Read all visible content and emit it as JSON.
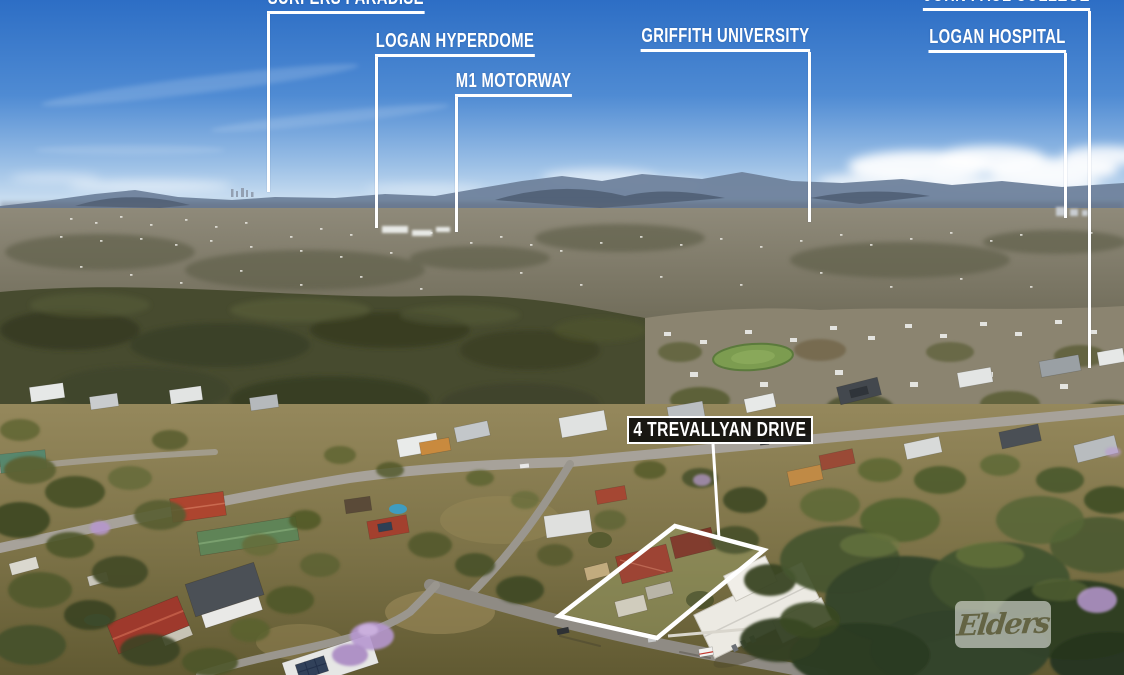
{
  "scene": {
    "type": "aerial-property-photo",
    "colors": {
      "callout_line": "#ffffff",
      "callout_text": "#ffffff",
      "property_box_bg": "#0a0a0a",
      "property_box_border": "#ffffff",
      "boundary_outline": "#ffffff",
      "sky_top": "#2d6ec5",
      "watermark_bg": "rgba(248,248,244,0.55)"
    }
  },
  "location_labels": [
    {
      "id": "surfers-paradise",
      "label": "SURFERS PARADISE"
    },
    {
      "id": "logan-hyperdome",
      "label": "LOGAN HYPERDOME"
    },
    {
      "id": "m1-motorway",
      "label": "M1 MOTORWAY"
    },
    {
      "id": "griffith-university",
      "label": "GRIFFITH UNIVERSITY"
    },
    {
      "id": "john-paul-college",
      "label": "JOHN PAUL COLLEGE"
    },
    {
      "id": "logan-hospital",
      "label": "LOGAN HOSPITAL"
    }
  ],
  "property_callout": {
    "label": "4 TREVALLYAN DRIVE"
  },
  "watermark": {
    "brand": "Elders"
  }
}
